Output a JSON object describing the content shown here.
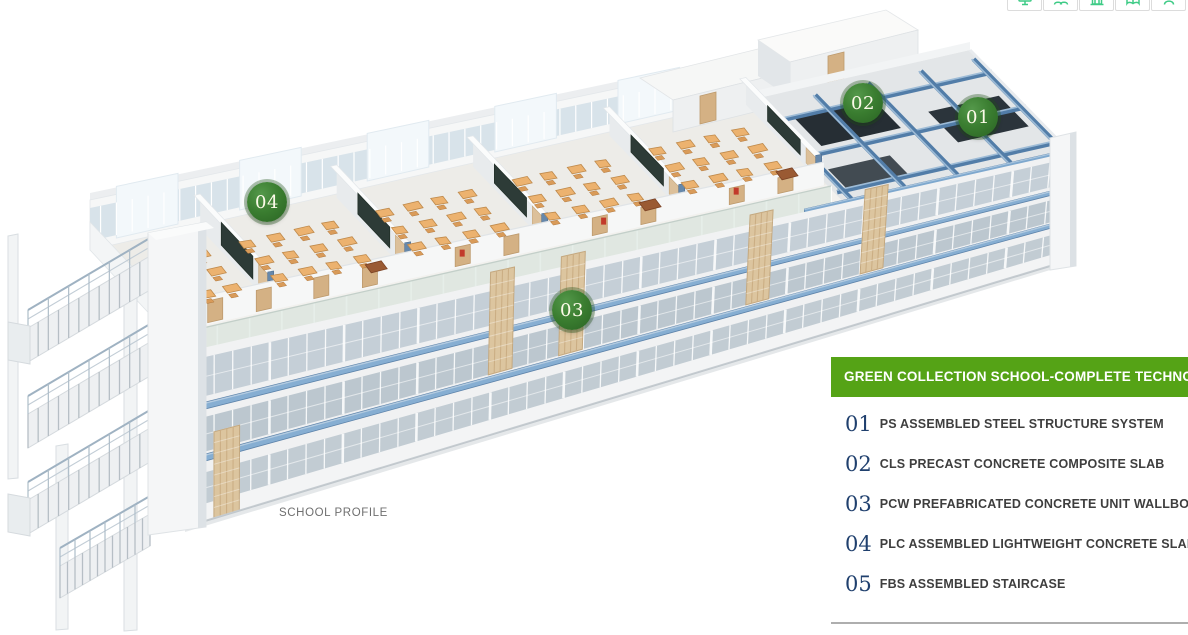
{
  "toolbar": {
    "buttons": [
      {
        "icon": "monitor-icon"
      },
      {
        "icon": "users-icon"
      },
      {
        "icon": "building-icon"
      },
      {
        "icon": "book-icon"
      },
      {
        "icon": "person-icon"
      }
    ]
  },
  "scene": {
    "caption": "SCHOOL PROFILE",
    "markers": [
      {
        "label": "01",
        "x": 978,
        "y": 117
      },
      {
        "label": "02",
        "x": 863,
        "y": 103
      },
      {
        "label": "03",
        "x": 572,
        "y": 310
      },
      {
        "label": "04",
        "x": 267,
        "y": 202
      }
    ]
  },
  "panel": {
    "title": "GREEN COLLECTION SCHOOL-COMPLETE TECHNOLOGY",
    "items": [
      {
        "num": "01",
        "text": "PS ASSEMBLED STEEL STRUCTURE SYSTEM"
      },
      {
        "num": "02",
        "text": "CLS PRECAST CONCRETE COMPOSITE SLAB"
      },
      {
        "num": "03",
        "text": "PCW PREFABRICATED CONCRETE UNIT WALLBOARD"
      },
      {
        "num": "04",
        "text": "PLC ASSEMBLED LIGHTWEIGHT CONCRETE SLAB"
      },
      {
        "num": "05",
        "text": "FBS ASSEMBLED STAIRCASE"
      }
    ]
  },
  "colors": {
    "banner_green": "#55a316",
    "legend_number_blue": "#20406e",
    "legend_text": "#3e3e3e",
    "caption_gray": "#6f6f6f",
    "icon_green": "#3ecb86",
    "badge_green": "#3a7d30",
    "badge_green_dark": "#2a6323",
    "badge_green_light": "#54984a",
    "steel_blue": "#527da8",
    "wood_tan": "#d4b184",
    "desk_orange": "#ecb26f"
  }
}
